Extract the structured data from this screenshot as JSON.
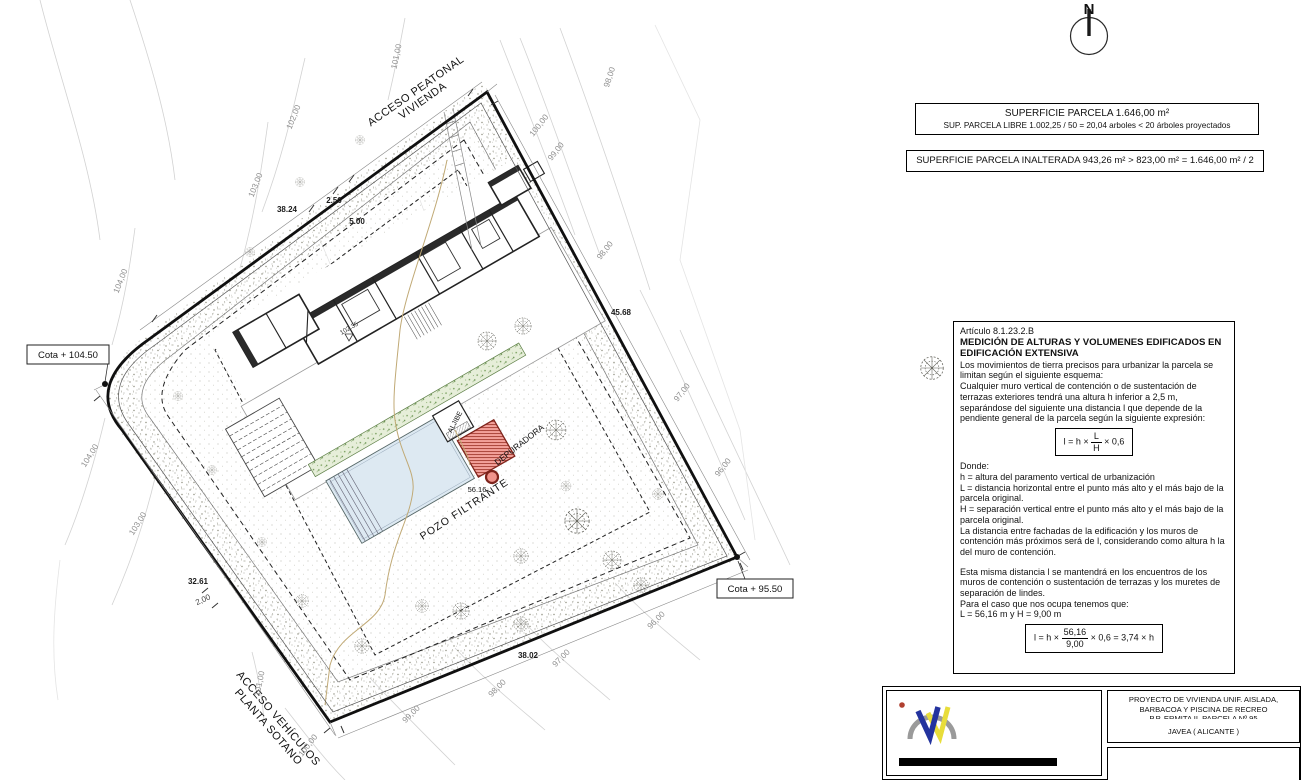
{
  "colors": {
    "boundary": "#101010",
    "contour": "#c9c9c9",
    "pool_fill": "#dde9f2",
    "red_fill": "#f2a09a",
    "red_line": "#a23b30",
    "green_strip": "#e6eed9",
    "tan_line": "#c0a975"
  },
  "north": {
    "label": "N"
  },
  "info_boxes": {
    "parcela": {
      "line1": "SUPERFICIE PARCELA 1.646,00 m²",
      "line2": "SUP. PARCELA LIBRE 1.002,25 / 50  =  20,04 arboles  <  20 árboles proyectados"
    },
    "inalterada": {
      "line1": "SUPERFICIE PARCELA INALTERADA 943,26 m² > 823,00 m² = 1.646,00 m² / 2"
    }
  },
  "article": {
    "ref": "Artículo 8.1.23.2.B",
    "title1": "MEDICIÓN DE ALTURAS Y VOLUMENES EDIFICADOS EN",
    "title2": "EDIFICACIÓN EXTENSIVA",
    "p1": "Los movimientos de tierra precisos para urbanizar la parcela se limitan según el siguiente esquema:",
    "p2": "Cualquier muro vertical de contención o de sustentación de terrazas exteriores tendrá una altura h inferior a 2,5 m, separándose del siguiente una distancia l que depende de la pendiente general de la parcela según la siguiente expresión:",
    "formula1": {
      "lhs": "l = h ×",
      "num": "L",
      "den": "H",
      "rhs": "× 0,6"
    },
    "donde": "Donde:",
    "def_h": "h = altura del paramento vertical de urbanización",
    "def_l": "L = distancia horizontal entre el punto más alto y el más bajo de la parcela original.",
    "def_hh": "H = separación vertical entre el punto más alto y el más bajo de la parcela original.",
    "p3": "La distancia entre fachadas de la edificación y los muros de contención más próximos será de l, considerando como altura h la del muro de contención.",
    "p4": "Esta misma distancia l se mantendrá en los encuentros de los muros de contención o sustentación de terrazas y los muretes de separación de lindes.",
    "p5": "Para el caso que nos ocupa tenemos que:",
    "p6": "L = 56,16 m    y    H = 9,00 m",
    "formula2": {
      "lhs": "l = h ×",
      "num": "56,16",
      "den": "9,00",
      "rhs": "× 0,6 = 3,74 × h"
    }
  },
  "title_block": {
    "line1": "PROYECTO DE VIVIENDA UNIF. AISLADA,",
    "line2": "BARBACOA Y PISCINA DE RECREO",
    "line3": "P.P. ERMITA II. PARCELA Nº 95",
    "location": "JAVEA ( ALICANTE )"
  },
  "plan": {
    "access_top_1": "ACCESO PEATONAL",
    "access_top_2": "VIVIENDA",
    "access_bottom_1": "ACCESO VEHÍCULOS",
    "access_bottom_2": "PLANTA SOTANO",
    "cota_high": "Cota + 104.50",
    "cota_low": "Cota + 95.50",
    "pozo": "POZO FILTRANTE",
    "depuradora": "DEPURADORA",
    "aljibe": "ALJIBE",
    "spot_level": "102.35",
    "dist": "56.16",
    "dims": {
      "d1": "38.24",
      "d2": "2.50",
      "d3": "5.00",
      "d4": "45.68",
      "d5": "38.02",
      "d6": "32.61",
      "d7": "2,00"
    },
    "contours": {
      "c101t": "101,00",
      "c102": "102,00",
      "c103": "103,00",
      "c104": "104,00",
      "c100t": "100,00",
      "c99t": "99,00",
      "c98t": "98,00",
      "c98r": "98,00",
      "c97r": "97,00",
      "c96r": "96,00",
      "c104b": "104,00",
      "c103b": "103,00",
      "c101b": "101,00",
      "c100b": "100,00",
      "c99b": "99,00",
      "c98b": "98,00",
      "c97b": "97,00",
      "c96b": "96,00"
    }
  }
}
